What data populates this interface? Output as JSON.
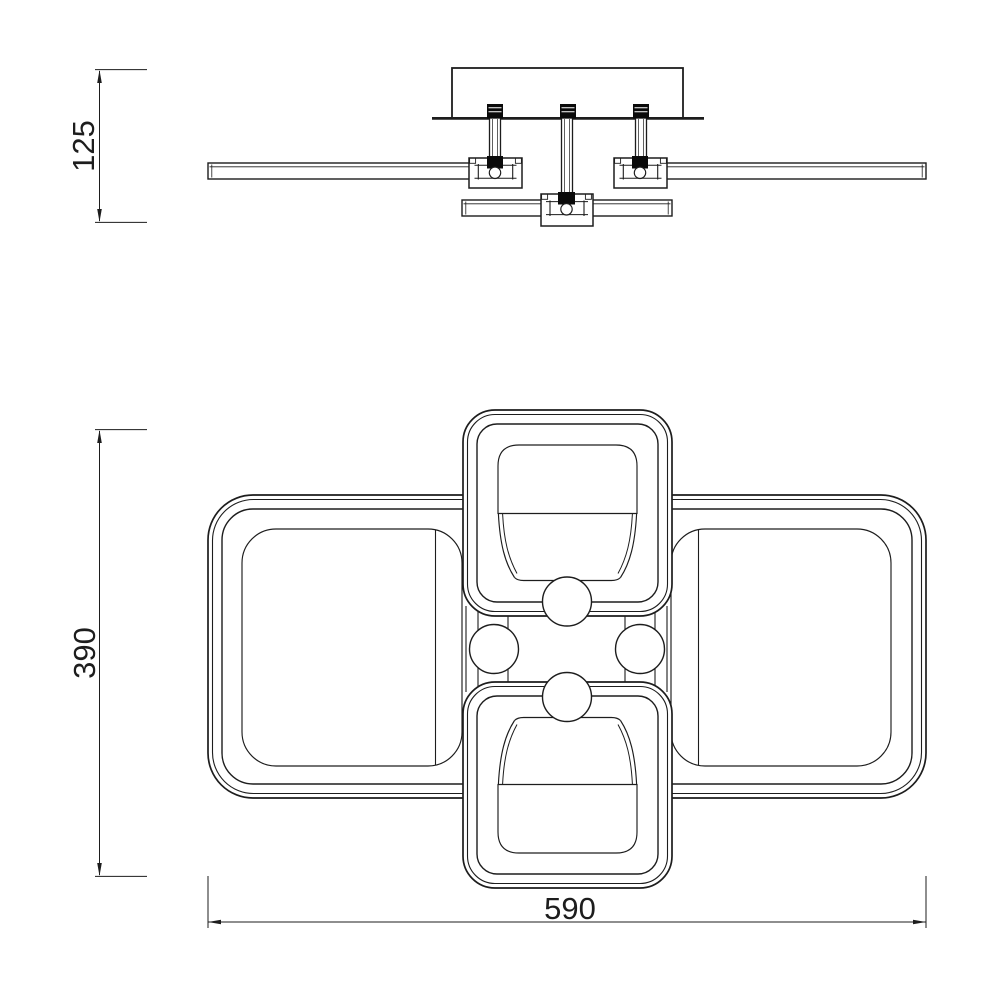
{
  "drawing": {
    "description": "technical drawing of LED ceiling light, side elevation and plan view",
    "dimensions": {
      "side_height": {
        "value": "125"
      },
      "plan_height": {
        "value": "390"
      },
      "plan_width": {
        "value": "590"
      }
    },
    "colors": {
      "line": "#1d1d1d",
      "background": "#ffffff",
      "solid_fill": "#0a0a0a"
    }
  }
}
